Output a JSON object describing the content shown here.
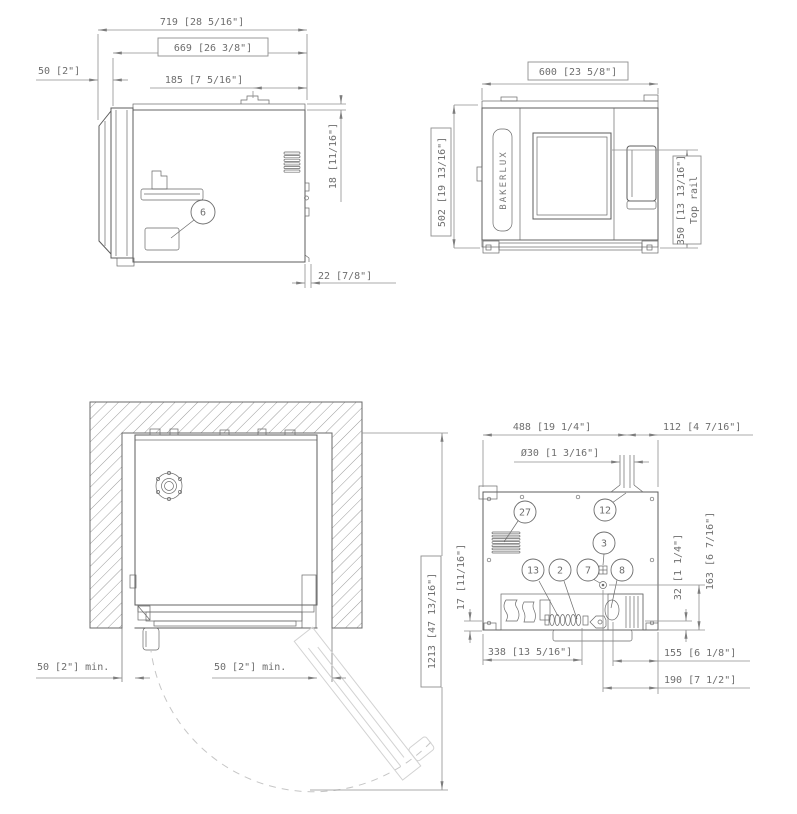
{
  "drawing": {
    "side_view": {
      "dims": {
        "overall_depth": "719 [28 5/16\"]",
        "body_depth": "669 [26 3/8\"]",
        "door_offset": "50 [2\"]",
        "flue_from_back": "185 [7 5/16\"]",
        "lid_height": "18 [11/16\"]",
        "rear_offset": "22 [7/8\"]"
      },
      "callouts": {
        "rating_plate": "6"
      }
    },
    "front_view": {
      "brand": "BAKERLUX",
      "dims": {
        "width": "600 [23 5/8\"]",
        "height": "502 [19 13/16\"]",
        "top_rail": "350 [13 13/16\"]",
        "top_rail_label": "Top rail"
      }
    },
    "top_view": {
      "dims": {
        "left_clearance": "50 [2\"] min.",
        "right_clearance": "50 [2\"] min.",
        "door_open_depth": "1213 [47 13/16\"]"
      }
    },
    "rear_view": {
      "dims": {
        "flue_from_left": "488 [19 1/4\"]",
        "flue_from_right": "112 [4 7/16\"]",
        "flue_diameter": "Ø30 [1 3/16\"]",
        "drain_height": "32 [1 1/4\"]",
        "outlet_height": "163 [6 7/16\"]",
        "foot_height": "17 [11/16\"]",
        "gas_from_left": "338 [13 5/16\"]",
        "drain_from_right": "155 [6 1/8\"]",
        "cable_from_right": "190 [7 1/2\"]"
      },
      "callouts": {
        "c27": "27",
        "c12": "12",
        "c3": "3",
        "c13": "13",
        "c2": "2",
        "c7": "7",
        "c8": "8"
      }
    },
    "colors": {
      "line": "#5c5c5c",
      "dim": "#8f8f8f",
      "text": "#6e6e6e",
      "ghost": "#d2d2d2",
      "bg": "#ffffff"
    }
  }
}
